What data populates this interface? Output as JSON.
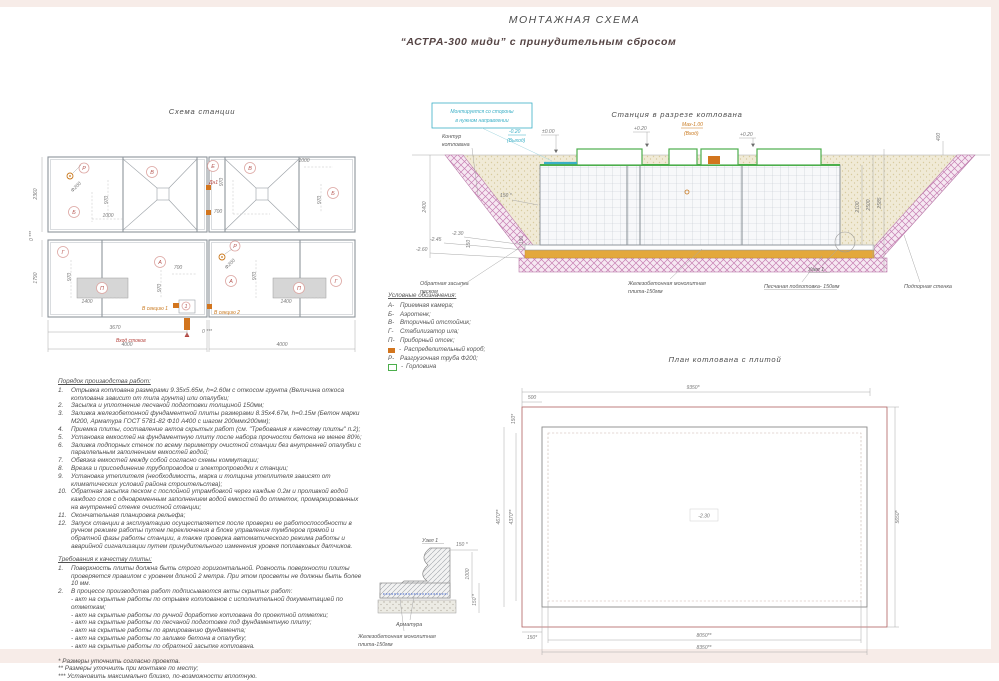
{
  "header": {
    "title": "МОНТАЖНАЯ СХЕМА",
    "subtitle": "“АСТРА-300 миди” с принудительным сбросом"
  },
  "station_plan": {
    "title": "Схема станции",
    "dims": {
      "w2360": "2360",
      "h1790": "1790",
      "d970": "970",
      "d1000": "1000",
      "d700": "700",
      "d1400": "1400",
      "d3670": "3670",
      "d4000": "4000",
      "gap": "0 ***",
      "f200": "Ф200"
    },
    "labels": {
      "A": "А",
      "B": "Б",
      "V": "В",
      "G": "Г",
      "E": "Е",
      "P": "П",
      "R": "Р",
      "n1": "1",
      "dn1": "Дн1",
      "inlet": "Вход стоков",
      "sec1": "В секцию 1",
      "sec2": "В секцию 2"
    }
  },
  "section_view": {
    "title": "Станция в разрезе котлована",
    "note_line1": "Монтируется со стороны",
    "note_line2": "в нужном направлении",
    "kontur1": "Контур",
    "kontur2": "котлована",
    "out_level": "-0.20",
    "out_label": "(Выход)",
    "lvl0": "±0.00",
    "lvl20": "+0.20",
    "max_level": "Мах-1.00",
    "max_label": "(Вход)",
    "d400": "400",
    "d2400": "2400",
    "d2100": "2100",
    "d2500": "2500",
    "d2585": "2585",
    "d150s": "150 *",
    "d150": "150",
    "m230": "-2.30",
    "m245": "-2.45",
    "m260": "-2.60",
    "backfill1": "Обратная засыпка",
    "backfill2": "песком",
    "plate1": "Железобетонная монолитная",
    "plate2": "плита-150мм",
    "sand": "Песчаная подготовка- 150мм",
    "wall": "Подпорная стенка",
    "node": "Узел 1"
  },
  "legend": {
    "title": "Условные обозначения:",
    "items": [
      {
        "key": "А-",
        "text": "Приемная камера;"
      },
      {
        "key": "Б-",
        "text": "Аэротенк;"
      },
      {
        "key": "В-",
        "text": "Вторичный отстойник;"
      },
      {
        "key": "Г-",
        "text": "Стабилизатор ила;"
      },
      {
        "key": "П-",
        "text": "Приборный отсек;"
      },
      {
        "key": "-",
        "text": "Распределительный короб;"
      },
      {
        "key": "Р-",
        "text": "Разгрузочная труба Ф200;"
      },
      {
        "key": "-",
        "text": "Горловина"
      }
    ]
  },
  "pit_plan": {
    "title": "План котлована с плитой",
    "d9350": "9350*",
    "d5650": "5650*",
    "d500": "500",
    "d150": "150*",
    "d4670": "4670**",
    "d4370": "4370**",
    "d8050": "8050**",
    "d8350": "8350**",
    "lvl": "-2.30"
  },
  "node_detail": {
    "title": "Узел 1",
    "d150t": "150 *",
    "d1000": "1000",
    "d150p": "150 *",
    "rebar": "Арматура",
    "plate1": "Железобетонная монолитная",
    "plate2": "плита-150мм"
  },
  "procedure": {
    "title": "Порядок производства работ:",
    "items": [
      {
        "n": "1.",
        "t": "Отрывка котлована размерами 9.35х5.65м, h=2.60м с откосом грунта (Величина откоса котлована зависит от типа грунта) или опалубки;"
      },
      {
        "n": "2.",
        "t": "Засыпка и уплотнение песчаной подготовки толщиной 150мм;"
      },
      {
        "n": "3.",
        "t": "Заливка железобетонной фундаментной плиты размерами 8.35х4.67м, h=0.15м (Бетон марки М200, Арматура ГОСТ 5781-82 Ф10 А400 с шагом 200ммх200мм);"
      },
      {
        "n": "4.",
        "t": "Приемка плиты, составление актов скрытых работ (см. \"Требования к качеству плиты\" п.2);"
      },
      {
        "n": "5.",
        "t": "Установка емкостей на фундаментную плиту после набора прочности бетона не менее 80%;"
      },
      {
        "n": "6.",
        "t": "Заливка подпорных стенок по всему периметру очистной станции без внутренней опалубки с параллельным заполнением емкостей водой;"
      },
      {
        "n": "7.",
        "t": "Обвязка емкостей между собой согласно схемы коммутации;"
      },
      {
        "n": "8.",
        "t": "Врезка и присоединение трубопроводов и электропроводки к станции;"
      },
      {
        "n": "9.",
        "t": "Установка утеплителя (необходимость, марка и толщина утеплителя зависят от климатических условий района строительства);"
      },
      {
        "n": "10.",
        "t": "Обратная засыпка песком с послойной утрамбовкой через каждые 0.2м и проливкой водой каждого слоя с одновременным заполнением водой емкостей до отметок, промаркированных на внутренней стенке очистной станции;"
      },
      {
        "n": "11.",
        "t": "Окончательная планировка рельефа;"
      },
      {
        "n": "12.",
        "t": "Запуск станции в эксплуатацию осуществляется после проверки ее работоспособности в ручном режиме работы путем переключения в блоке управления тумблеров прямой и обратной фазы работы станции, а также проверка автоматического режима работы и аварийной сигнализации путем принудительного изменения уровня поплавковых датчиков."
      }
    ]
  },
  "quality": {
    "title": "Требования к качеству плиты:",
    "items": [
      {
        "n": "1.",
        "t": "Поверхность плиты должна быть строго горизонтальной. Ровность поверхности плиты проверяется правилом с уровнем длиной 2 метра. При этом просветы не должны быть более 10 мм."
      },
      {
        "n": "2.",
        "t": "В процессе производства работ подписываются акты скрытых работ:"
      }
    ],
    "acts": [
      "- акт на скрытые работы по отрывке котлованов с исполнительной документацией по отметкам;",
      "- акт на скрытые работы по ручной доработке котлована до проектной отметки;",
      "- акт на скрытые работы по песчаной подготовке под фундаментную плиту;",
      "- акт на скрытые работы по армированию фундамента;",
      "- акт на скрытые работы по заливке бетона в опалубку;",
      "- акт на скрытые работы по обратной засыпке котлована."
    ]
  },
  "footnotes": [
    "* Размеры уточнить согласно проекта.",
    "** Размеры уточнить при монтаже по месту;",
    "*** Установить максимально близко, по-возможности вплотную."
  ]
}
